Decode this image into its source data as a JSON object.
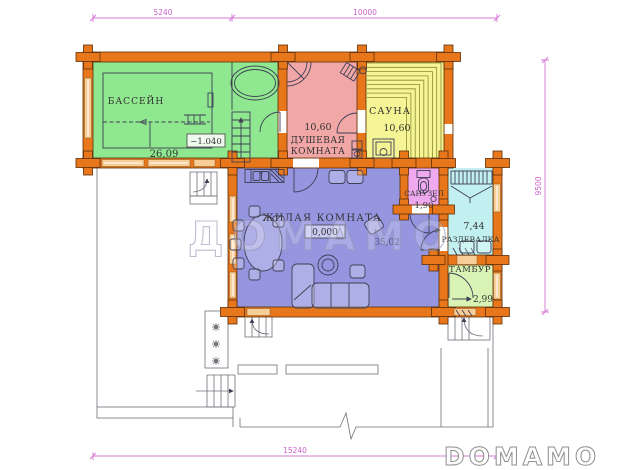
{
  "plan": {
    "watermark": "ДОМАМО",
    "logo": "DOMAMO",
    "dimensions": {
      "top_left": "5240",
      "top_right": "10000",
      "bottom": "15240",
      "right": "9500"
    },
    "rooms": {
      "pool": {
        "name": "БАССЕЙН",
        "area": "26,09",
        "level": "−1.040"
      },
      "shower": {
        "name_line1": "ДУШЕВАЯ",
        "name_line2": "КОМНАТА",
        "area": "10,60"
      },
      "sauna": {
        "name": "САУНА",
        "area": "10,60"
      },
      "living": {
        "name": "ЖИЛАЯ КОМНАТА",
        "area": "35,02",
        "level": "0,000"
      },
      "wc": {
        "name": "САНУЗЕЛ",
        "area": "1,90"
      },
      "dressing": {
        "name": "РАЗДЕВАЛКА",
        "area": "7,44"
      },
      "vestibule": {
        "name": "ТАМБУР",
        "area": "2,99"
      }
    },
    "colors": {
      "wall": "#E8771C",
      "pool_room": "#8FE78F",
      "shower_room": "#F2A7A7",
      "sauna_room": "#F6F595",
      "living_room": "#9595E0",
      "wc_room": "#EFA9EF",
      "dressing_room": "#C2F0F0",
      "vestibule_room": "#D9F3B5",
      "dimension": "#D678D6",
      "window": "#F8CE98"
    }
  }
}
